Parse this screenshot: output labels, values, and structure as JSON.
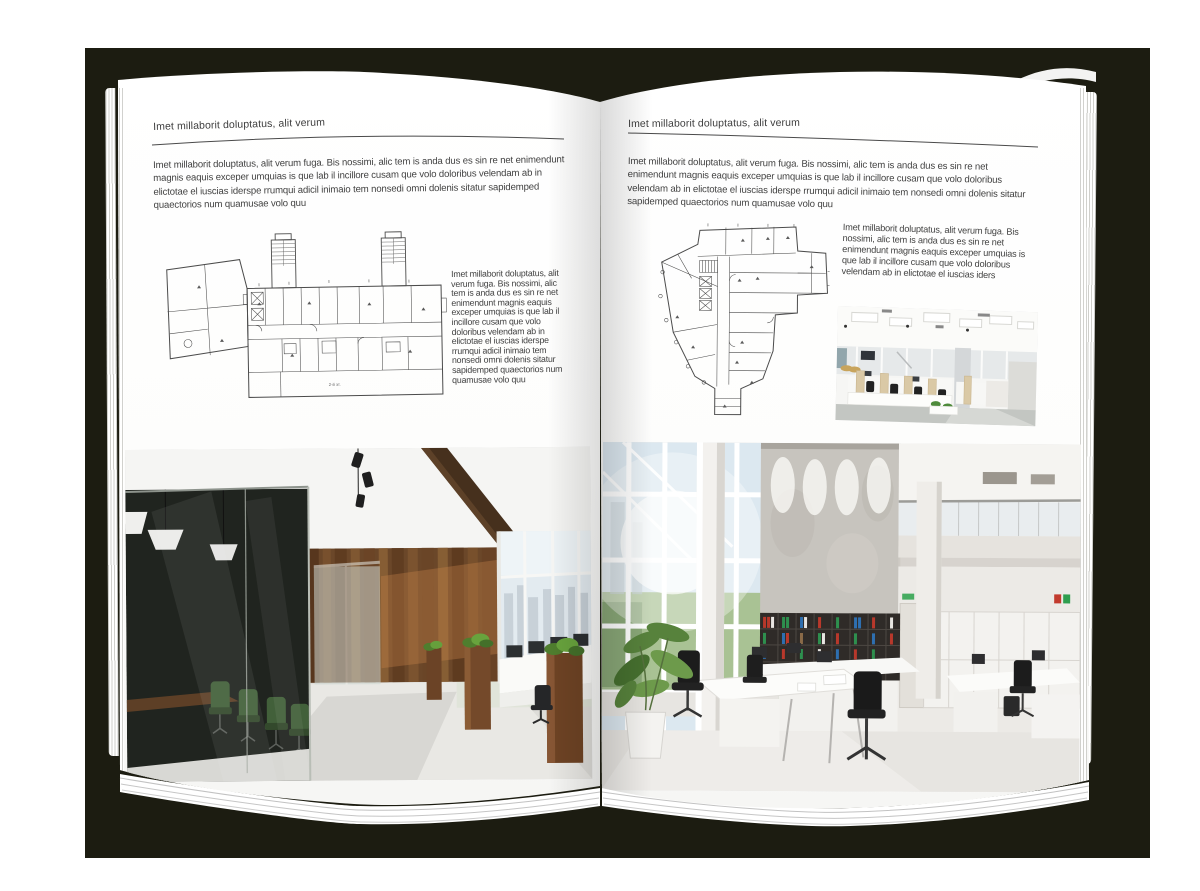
{
  "book": {
    "left": {
      "header": "Imet millaborit doluptatus, alit verum",
      "intro": "Imet millaborit doluptatus, alit verum fuga. Bis nossimi, alic tem is anda dus es sin re net enimendunt magnis eaquis exceper umquias is que lab il incillore cusam que volo doloribus velendam ab in elictotae el iuscias iderspe rrumqui adicil inimaio tem nonsedi omni dolenis sitatur sapidemped quaectorios num quamusae volo quu",
      "side_text": "Imet millaborit doluptatus, alit verum fuga. Bis nossimi, alic tem is anda dus es sin re net enimendunt magnis eaquis exceper umquias is que lab il incillore cusam que volo doloribus velendam ab in elictotae el iuscias iderspe rrumqui adicil inimaio tem nonsedi omni dolenis sitatur sapidemped quaectorios num quamusae volo quu",
      "plan_label": "2-й эт."
    },
    "right": {
      "header": "Imet millaborit doluptatus, alit verum",
      "intro": "Imet millaborit doluptatus, alit verum fuga. Bis nossimi, alic tem is anda dus es sin re net enimendunt magnis eaquis exceper umquias is que lab il incillore cusam que volo doloribus velendam ab in elictotae el iuscias iderspe rrumqui adicil inimaio tem nonsedi omni dolenis sitatur sapidemped quaectorios num quamusae volo quu",
      "side_text": "Imet millaborit doluptatus, alit verum fuga. Bis nossimi, alic tem is anda dus es sin re net enimendunt magnis eaquis exceper umquias is que lab il incillore cusam que volo doloribus velendam ab in elictotae el iuscias iders"
    },
    "colors": {
      "backdrop": "#1c1c11",
      "page": "#ffffff",
      "body_text": "#424242",
      "rule": "#4a4a4a",
      "plan_line": "#4b4b4b"
    }
  }
}
